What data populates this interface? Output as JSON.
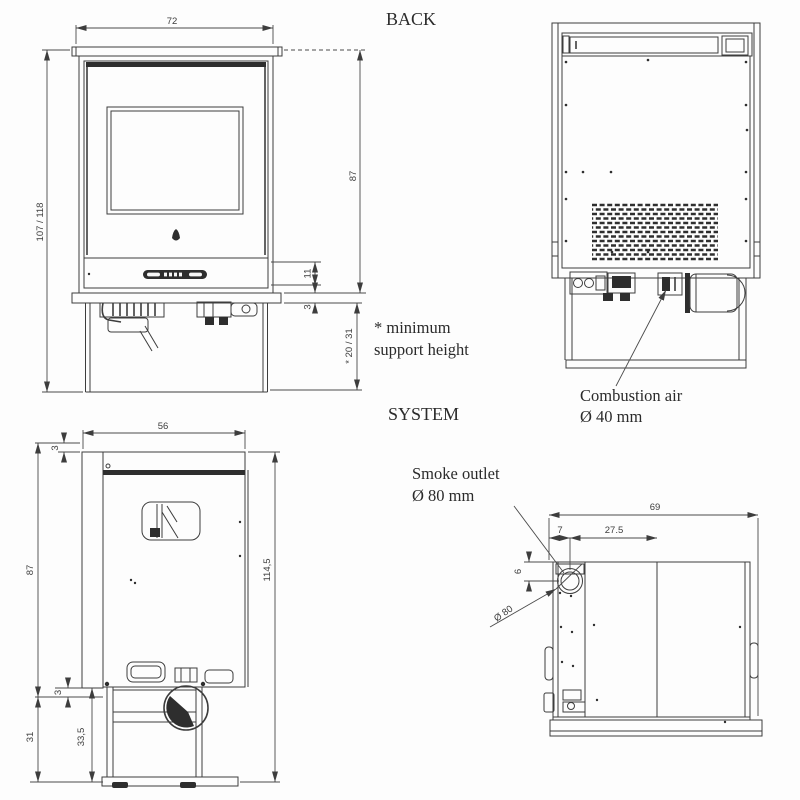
{
  "labels": {
    "back_view": "BACK",
    "system_view": "SYSTEM"
  },
  "notes": {
    "support_note_line1": "* minimum",
    "support_note_line2": "support height",
    "combustion_air_line1": "Combustion air",
    "combustion_air_line2": "Ø 40 mm",
    "smoke_outlet_line1": "Smoke outlet",
    "smoke_outlet_line2": "Ø 80 mm"
  },
  "front": {
    "width": "72",
    "total_height": "107 / 118",
    "body_height": "87",
    "panel_height": "11",
    "plinth": "3",
    "support_height": "* 20 / 31"
  },
  "side": {
    "depth": "56",
    "top_gap": "3",
    "body_height": "87",
    "total_height": "114,5",
    "rear_gap": "3",
    "support_height": "31",
    "support_height_alt": "33,5"
  },
  "top": {
    "width": "69",
    "outlet_edge_offset": "7",
    "outlet_center_offset": "27.5",
    "outlet_top_offset": "6",
    "outlet_diameter": "Ø 80"
  }
}
